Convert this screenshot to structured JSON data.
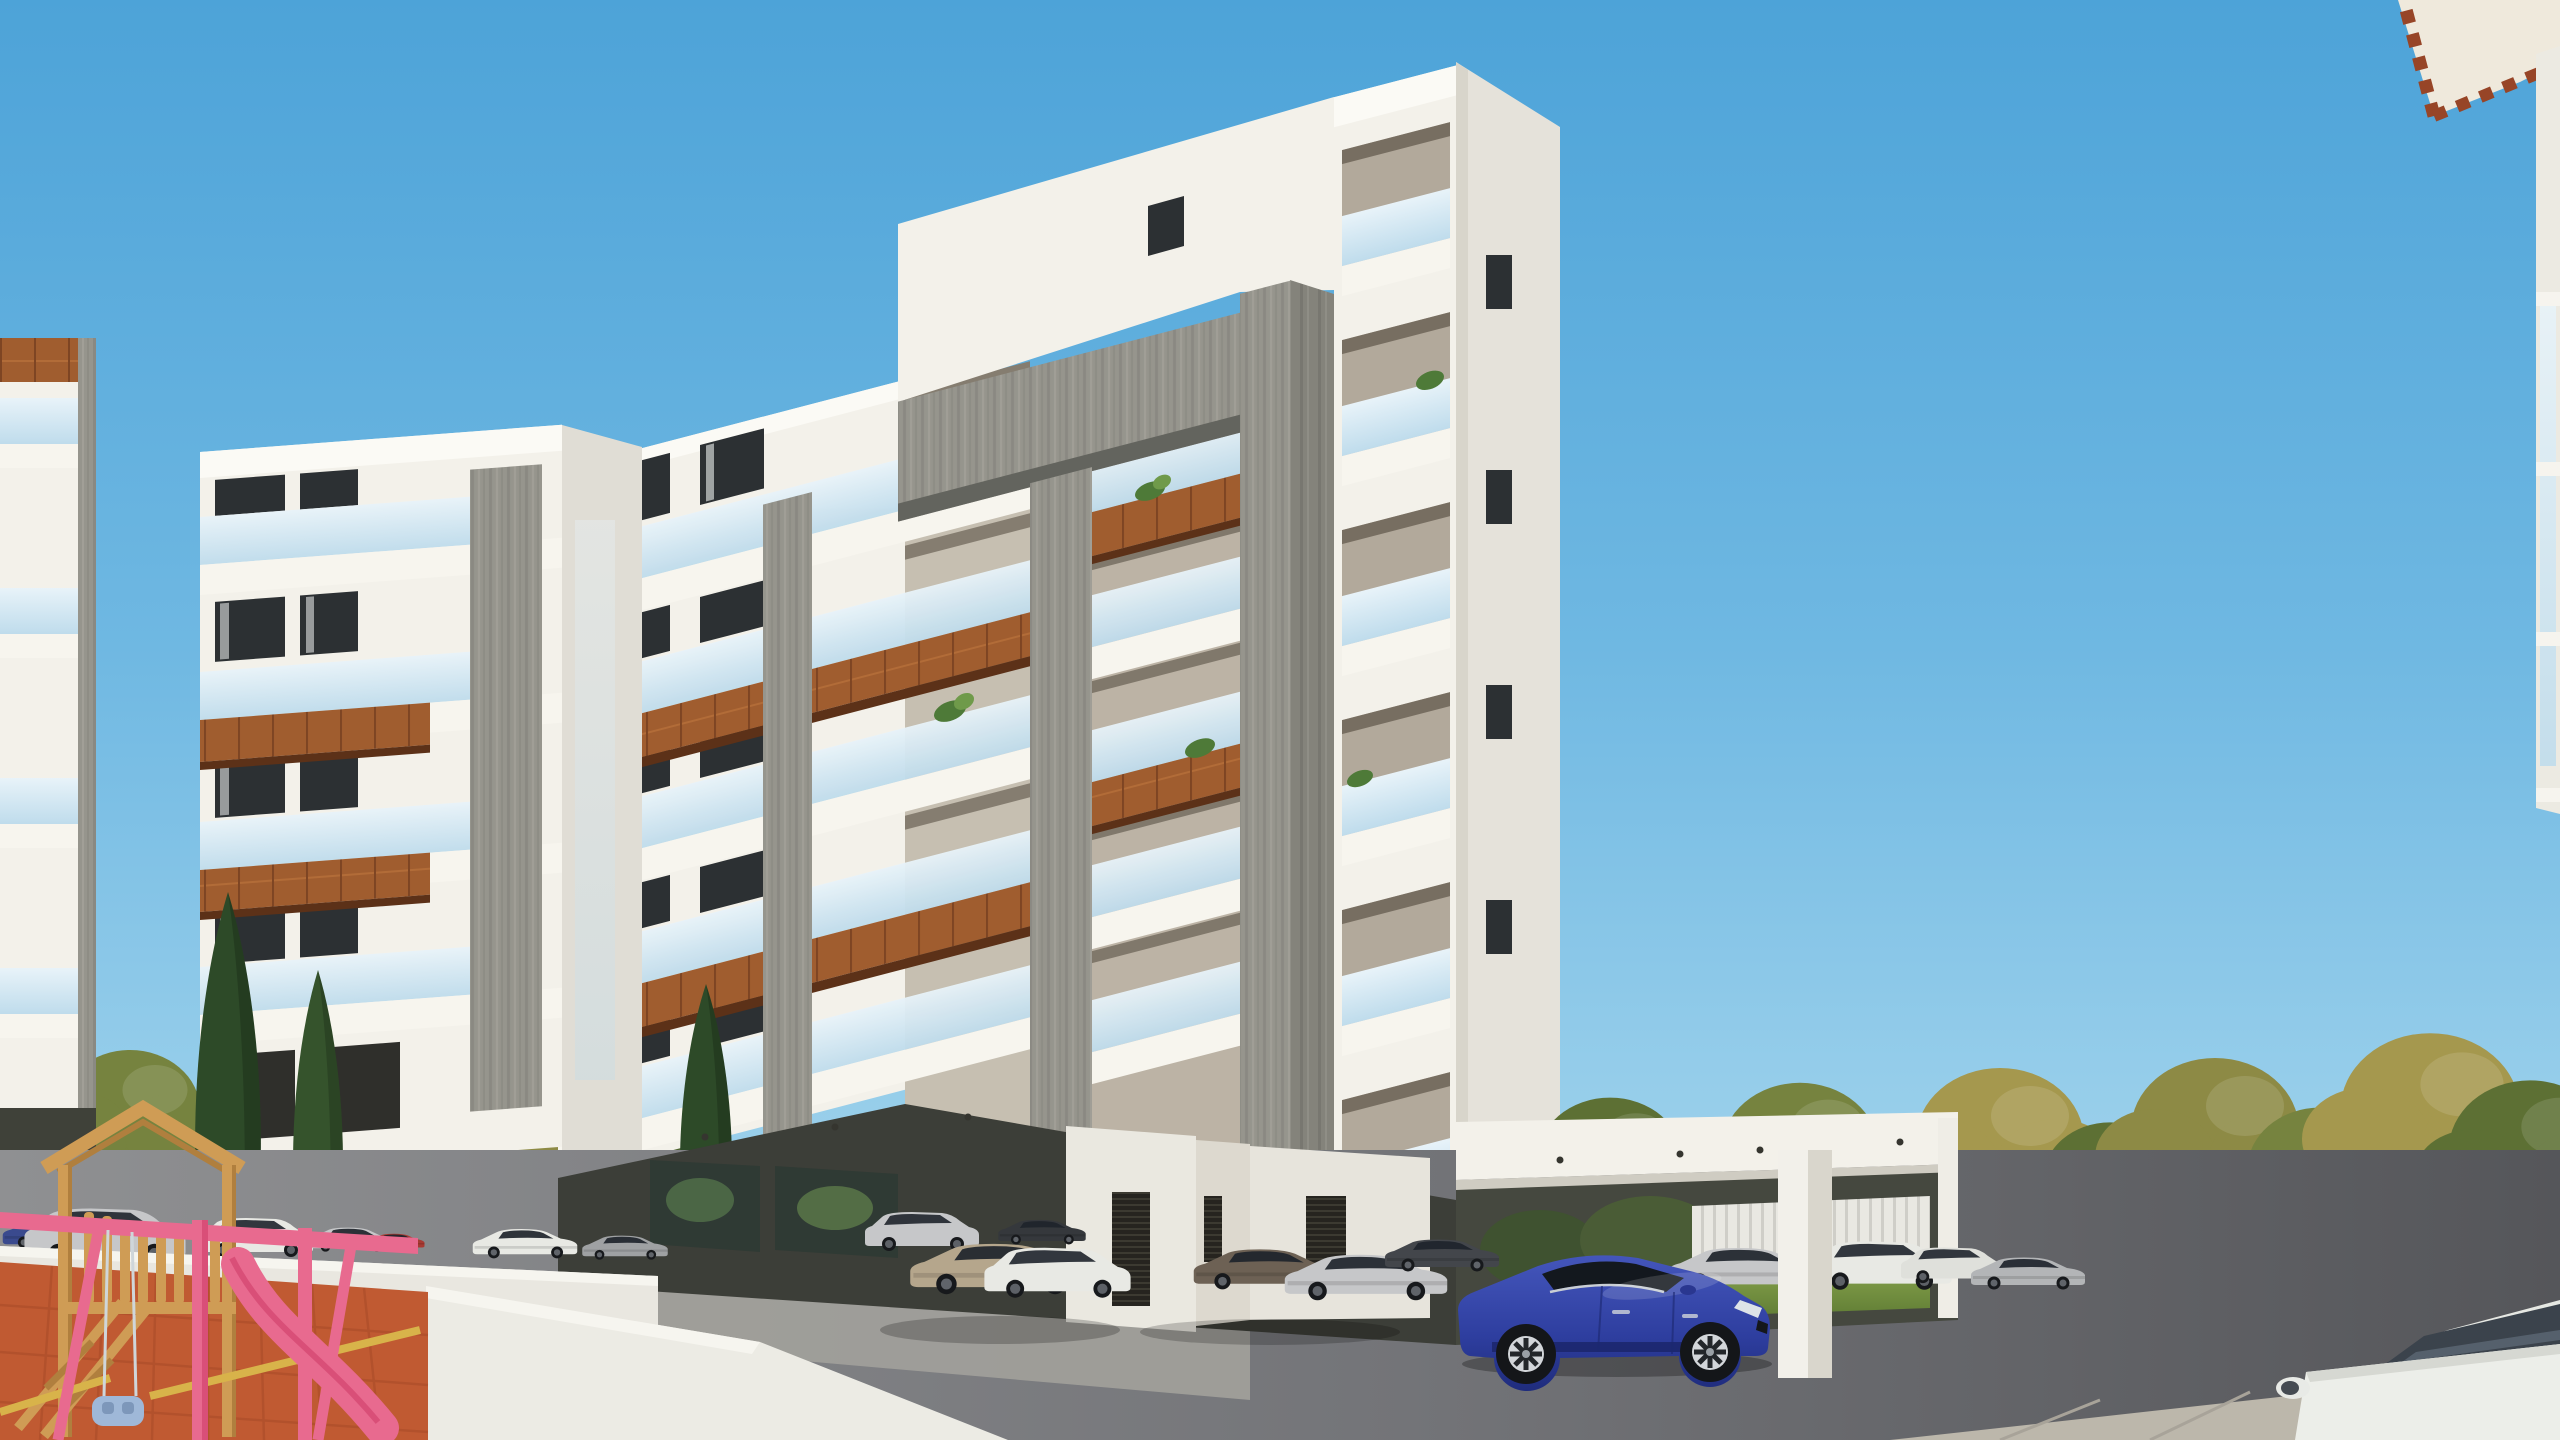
{
  "scene": {
    "type": "architectural-3d-render",
    "setting": "modern white apartment complex with wood-accent balconies, parking court, playground and autumn trees under a clear blue sky",
    "text_visible": "",
    "elements": [
      "sky",
      "main-apartment-building",
      "left-apartment-building",
      "left-wing-building",
      "far-left-building-sliver",
      "neighbor-roof-corner",
      "parking-lot",
      "cars",
      "playground",
      "trees",
      "boundary-walls",
      "lawn"
    ]
  },
  "palette": {
    "sky_top": "#4da3d8",
    "sky_mid": "#7fc2e6",
    "sky_low": "#aedaf0",
    "white_lit": "#f3f1ea",
    "white_bright": "#fbfaf5",
    "white_shade": "#e5e2da",
    "white_shade2": "#d8d5cb",
    "wall_white": "#e9e7e0",
    "interior": "#c6bfb1",
    "interior2": "#bcb3a5",
    "soffit": "#63645e",
    "corten": "#a05d2f",
    "corten_dark": "#5c3118",
    "window": "#2c3033",
    "curtain": "#c6c9c9",
    "undercroft": "#3c3e38",
    "pad": "#a09f9a",
    "paver": "#c2bdb1",
    "lawn": "#7b9a44",
    "lawn_d": "#5d7a33",
    "foliage1": "#76833f",
    "foliage2": "#5d7034",
    "foliage3": "#8d8a45",
    "foliage4": "#a5984e",
    "foliage5": "#4f6530",
    "cypress": "#2d4a28",
    "trunk": "#4c3e30",
    "terracotta": "#c05a32",
    "terracotta_d": "#a84b28",
    "wood": "#cf9c55",
    "wood_d": "#b07f3e",
    "pink": "#e86a8f",
    "pink_d": "#d94f78",
    "babyblue": "#9fb8d8",
    "car_blue": "#2e3e9f",
    "car_champagne": "#b5a68c",
    "car_white": "#e8e9e4",
    "car_silver": "#c6c7c9",
    "car_gray": "#43464b",
    "car_dark": "#35383c",
    "car_bronze": "#6d6154",
    "car_red": "#a83a32",
    "car_navy": "#3a4a8e"
  },
  "buildings": [
    {
      "id": "main-building",
      "floors": 6,
      "features": [
        "gray wood-grain concrete portal frame",
        "white tower with recessed glass balconies",
        "corten wood fascia bands",
        "glass balustrades",
        "pilotis parking at ground level",
        "balcony plants"
      ]
    },
    {
      "id": "left-wing-building",
      "floors": 5,
      "features": [
        "white cantilevered balcony slabs",
        "two corten fascia bands",
        "gray concrete column",
        "dark framed windows with curtains"
      ]
    },
    {
      "id": "left-building",
      "floors": 4,
      "features": [
        "corten balcony bands wrapping left corner",
        "glass balustrades",
        "gray stone column",
        "garage openings at base"
      ]
    },
    {
      "id": "far-left-building-sliver",
      "floors": 4,
      "features": [
        "glass balcony fronts",
        "corten top band"
      ]
    },
    {
      "id": "neighbor-roof-corner",
      "floors": 1,
      "features": [
        "cream eave with terracotta dentil trim",
        "white pier with glass balustrade on right edge"
      ]
    }
  ],
  "vehicles": [
    {
      "name": "blue-sports-sedan",
      "color_key": "car_blue",
      "position": "front-center under main building"
    },
    {
      "name": "champagne-sedan",
      "color_key": "car_champagne",
      "position": "center, rear three-quarter view"
    },
    {
      "name": "white-suv",
      "color_key": "car_white",
      "position": "center, facing viewer"
    },
    {
      "name": "bronze-hatchback",
      "color_key": "car_bronze",
      "position": "right of door wall"
    },
    {
      "name": "silver-sedan-rear",
      "color_key": "car_silver",
      "position": "beside bronze hatchback"
    },
    {
      "name": "dark-gray-sedan",
      "color_key": "car_gray",
      "position": "left of blue sedan"
    },
    {
      "name": "silver-sedan-right",
      "color_key": "car_silver",
      "position": "right of blue sedan"
    },
    {
      "name": "white-suv-right",
      "color_key": "car_white",
      "position": "under right pilotis"
    },
    {
      "name": "silver-suv-back",
      "color_key": "car_silver",
      "position": "back row under left wing"
    },
    {
      "name": "dark-sedan-back",
      "color_key": "car_dark",
      "position": "back row"
    },
    {
      "name": "navy-sedan-left",
      "color_key": "car_navy",
      "position": "behind playground wall"
    },
    {
      "name": "silver-estate-left",
      "color_key": "car_silver",
      "position": "behind playground wall"
    },
    {
      "name": "white-suv-left",
      "color_key": "car_white",
      "position": "behind playground wall"
    },
    {
      "name": "red-car-left",
      "color_key": "car_red",
      "position": "behind playground wall"
    },
    {
      "name": "white-car-foreground",
      "color_key": "car_white",
      "position": "bottom-right corner, hood and mirror visible"
    },
    {
      "name": "dark-parked-cars-background",
      "color_key": "car_dark",
      "position": "behind right boundary wall"
    }
  ],
  "playground": {
    "floor": "terracotta rubber tiles",
    "equipment": [
      "wooden climbing tower with gable",
      "wooden log fence",
      "pink swing frame",
      "pink slide",
      "light-blue baby swing",
      "wooden ladder beams"
    ]
  },
  "vegetation": {
    "right_band": "autumn olive and yellow-green trees behind white boundary wall with lawn",
    "left_clusters": "green and yellow trees behind left buildings",
    "cypresses": 3,
    "hedges": "dark green mounds with pink flowering shrubs along planter walls",
    "balcony_plants": "small green ferns and shrubs on several balconies"
  },
  "ground": {
    "surfaces": [
      "dark asphalt court",
      "light concrete pad",
      "beige paver sidewalks"
    ],
    "structures": [
      "white boundary wall right",
      "white planter walls bottom-left",
      "white pilotis columns",
      "dark louvered service doors",
      "white slat fence seen through pilotis"
    ]
  }
}
